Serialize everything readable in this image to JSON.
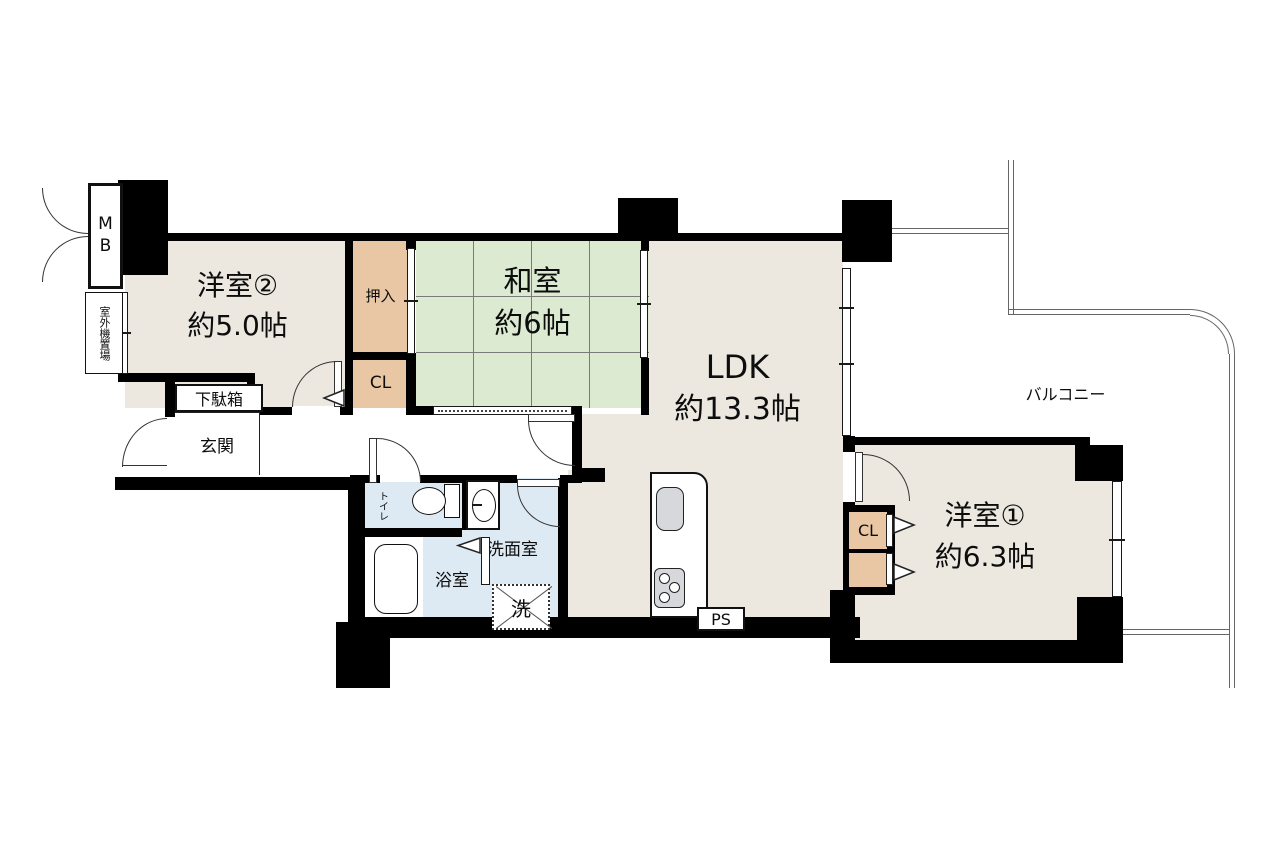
{
  "plan": {
    "rooms": {
      "room2": {
        "name": "洋室②",
        "size": "約5.0帖"
      },
      "washitsu": {
        "name": "和室",
        "size": "約6帖"
      },
      "ldk": {
        "name": "LDK",
        "size": "約13.3帖"
      },
      "room1": {
        "name": "洋室①",
        "size": "約6.3帖"
      }
    },
    "labels": {
      "meter_box": "MB",
      "outdoor_unit": "室外機置場",
      "oshiire": "押入",
      "closet2": "CL",
      "closet1": "CL",
      "shoe_cabinet": "下駄箱",
      "entrance": "玄関",
      "toilet": "トイレ",
      "washroom": "洗面室",
      "bathroom": "浴室",
      "laundry": "洗",
      "pipe_space": "PS",
      "balcony": "バルコニー"
    },
    "colors": {
      "wall": "#000000",
      "western_room_floor": "#ece8e0",
      "tatami": "#dcead2",
      "closet": "#e9c7a4",
      "wet_area": "#deeaf3",
      "fixture_gray": "#d6d8dc"
    }
  }
}
